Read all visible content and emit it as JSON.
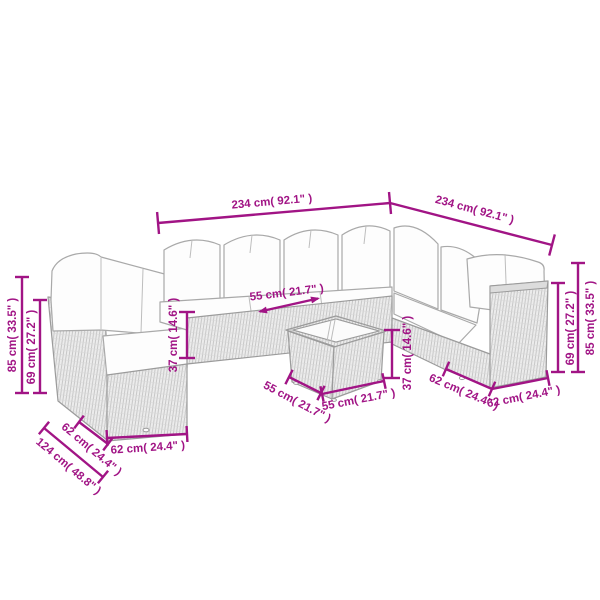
{
  "diagram": {
    "type": "product-dimension-diagram",
    "subject": "rattan-corner-sofa-set-with-table",
    "colors": {
      "dimension": "#a11485",
      "line_art": "#9b9b9b",
      "background": "#ffffff"
    }
  },
  "dims": [
    {
      "name": "back-row-width",
      "label": "234 cm( 92.1\" )"
    },
    {
      "name": "right-row-width",
      "label": "234 cm( 92.1\" )"
    },
    {
      "name": "left-back-height",
      "label": "85 cm( 33.5\" )"
    },
    {
      "name": "left-seatback-height",
      "label": "69 cm( 27.2\" )"
    },
    {
      "name": "seat-height",
      "label": "37 cm( 14.6\" )"
    },
    {
      "name": "seat-depth",
      "label": "55 cm( 21.7\" )"
    },
    {
      "name": "table-height",
      "label": "37 cm( 14.6\" )"
    },
    {
      "name": "table-depth",
      "label": "55 cm( 21.7\" )"
    },
    {
      "name": "table-width",
      "label": "55 cm( 21.7\" )"
    },
    {
      "name": "right-seatback-height",
      "label": "69 cm( 27.2\" )"
    },
    {
      "name": "right-back-height",
      "label": "85 cm( 33.5\" )"
    },
    {
      "name": "left-module-width",
      "label": "62 cm( 24.4\" )"
    },
    {
      "name": "left-wing-length",
      "label": "124 cm( 48.8\" )"
    },
    {
      "name": "front-module-width",
      "label": "62 cm( 24.4\" )"
    },
    {
      "name": "right-module-depth",
      "label": "62 cm( 24.4\" )"
    },
    {
      "name": "right-module-width",
      "label": "62 cm( 24.4\" )"
    }
  ]
}
